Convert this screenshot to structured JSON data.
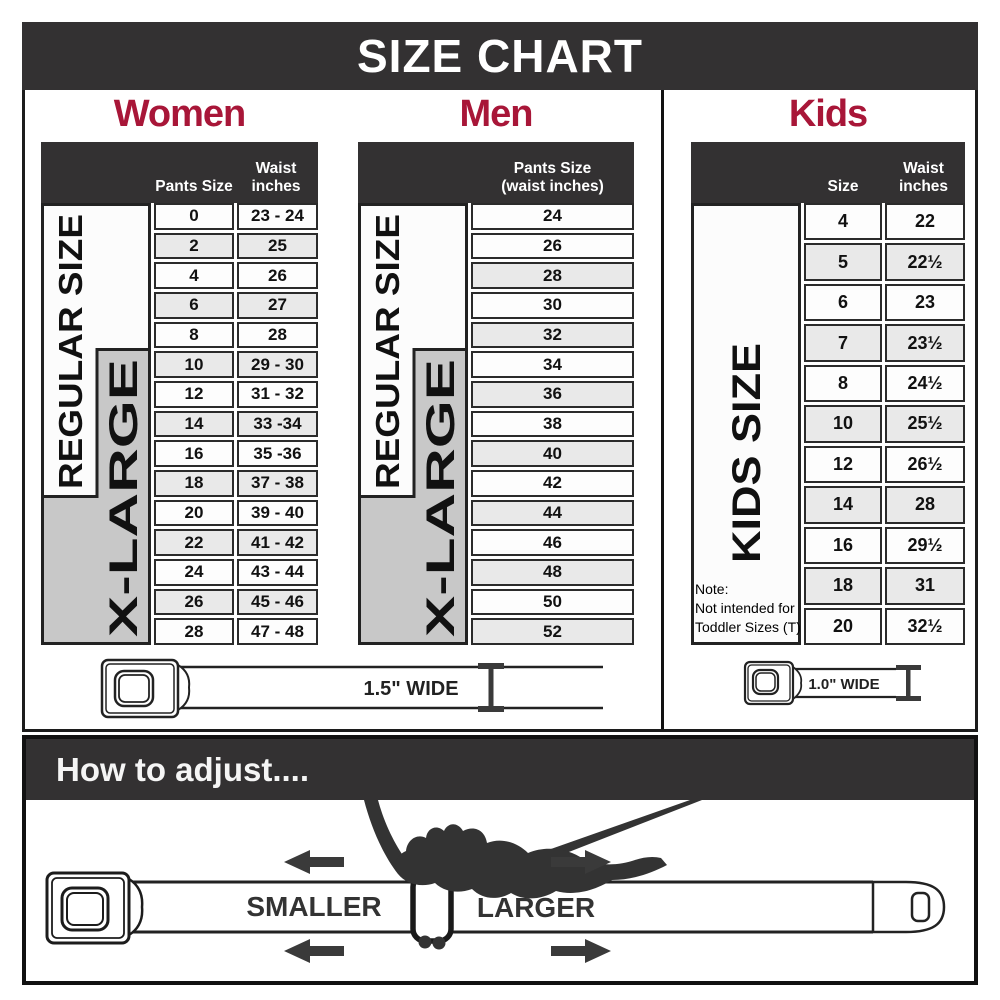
{
  "title": "SIZE CHART",
  "colors": {
    "band_dark": "#333132",
    "heading_red": "#A81638",
    "row_alt_gray": "#e9e9e9",
    "xlarge_gray": "#c8c8c8"
  },
  "women": {
    "heading": "Women",
    "col1_header": "Pants Size",
    "col2_header_line1": "Waist",
    "col2_header_line2": "inches",
    "regular_label": "REGULAR SIZE",
    "xlarge_label": "X-LARGE",
    "rows": [
      {
        "size": "0",
        "waist": "23 - 24"
      },
      {
        "size": "2",
        "waist": "25"
      },
      {
        "size": "4",
        "waist": "26"
      },
      {
        "size": "6",
        "waist": "27"
      },
      {
        "size": "8",
        "waist": "28"
      },
      {
        "size": "10",
        "waist": "29 - 30"
      },
      {
        "size": "12",
        "waist": "31 - 32"
      },
      {
        "size": "14",
        "waist": "33 -34"
      },
      {
        "size": "16",
        "waist": "35 -36"
      },
      {
        "size": "18",
        "waist": "37 - 38"
      },
      {
        "size": "20",
        "waist": "39 - 40"
      },
      {
        "size": "22",
        "waist": "41 - 42"
      },
      {
        "size": "24",
        "waist": "43 - 44"
      },
      {
        "size": "26",
        "waist": "45 - 46"
      },
      {
        "size": "28",
        "waist": "47 - 48"
      }
    ]
  },
  "men": {
    "heading": "Men",
    "col_header_line1": "Pants Size",
    "col_header_line2": "(waist inches)",
    "regular_label": "REGULAR SIZE",
    "xlarge_label": "X-LARGE",
    "rows": [
      "24",
      "26",
      "28",
      "30",
      "32",
      "34",
      "36",
      "38",
      "40",
      "42",
      "44",
      "46",
      "48",
      "50",
      "52"
    ]
  },
  "kids": {
    "heading": "Kids",
    "col1_header": "Size",
    "col2_header_line1": "Waist",
    "col2_header_line2": "inches",
    "label": "KIDS SIZE",
    "note_line1": "Note:",
    "note_line2": "Not intended for",
    "note_line3": "Toddler Sizes (T)",
    "rows": [
      {
        "size": "4",
        "waist": "22"
      },
      {
        "size": "5",
        "waist": "22½"
      },
      {
        "size": "6",
        "waist": "23"
      },
      {
        "size": "7",
        "waist": "23½"
      },
      {
        "size": "8",
        "waist": "24½"
      },
      {
        "size": "10",
        "waist": "25½"
      },
      {
        "size": "12",
        "waist": "26½"
      },
      {
        "size": "14",
        "waist": "28"
      },
      {
        "size": "16",
        "waist": "29½"
      },
      {
        "size": "18",
        "waist": "31"
      },
      {
        "size": "20",
        "waist": "32½"
      }
    ]
  },
  "belts": {
    "adult_width_label": "1.5\" WIDE",
    "kids_width_label": "1.0\" WIDE"
  },
  "adjust": {
    "heading": "How to adjust....",
    "smaller_label": "SMALLER",
    "larger_label": "LARGER"
  }
}
